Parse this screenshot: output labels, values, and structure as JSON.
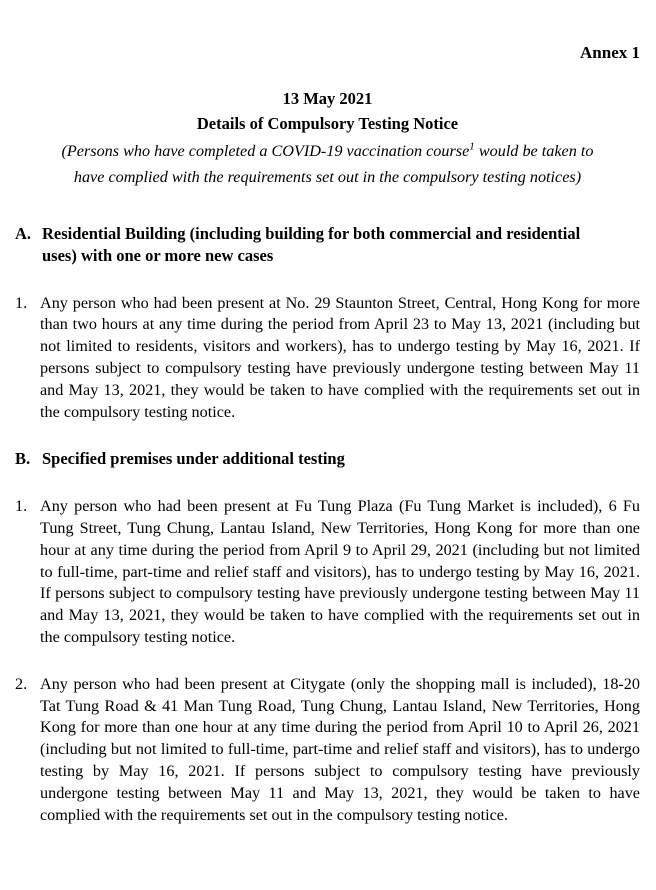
{
  "document": {
    "annex_label": "Annex 1",
    "date": "13 May 2021",
    "title": "Details of Compulsory Testing Notice",
    "subtitle": {
      "line1_before_sup": "(Persons who have completed a COVID-19 vaccination course",
      "footnote_ref": "1",
      "line1_after_sup": " would be taken to",
      "line2": "have complied with the requirements set out in the compulsory testing notices)"
    },
    "sections": [
      {
        "label": "A.",
        "heading": "Residential Building (including building for both commercial and residential uses) with one or more new cases",
        "items": [
          {
            "label": "1.",
            "text": "Any person who had been present at No. 29 Staunton Street, Central, Hong Kong for more than two hours at any time during the period from April 23 to May 13, 2021 (including but not limited to residents, visitors and workers), has to undergo testing by May 16, 2021. If persons subject to compulsory testing have previously undergone testing between May 11 and May 13, 2021, they would be taken to have complied with the requirements set out in the compulsory testing notice."
          }
        ]
      },
      {
        "label": "B.",
        "heading": "Specified premises under additional testing",
        "items": [
          {
            "label": "1.",
            "text": "Any person who had been present at Fu Tung Plaza (Fu Tung Market is included), 6 Fu Tung Street, Tung Chung, Lantau Island, New Territories, Hong Kong for more than one hour at any time during the period from April 9 to April 29, 2021 (including but not limited to full-time, part-time and relief staff and visitors), has to undergo testing by May 16, 2021. If persons subject to compulsory testing have previously undergone testing between May 11 and May 13, 2021, they would be taken to have complied with the requirements set out in the compulsory testing notice."
          },
          {
            "label": "2.",
            "text": "Any person who had been present at Citygate (only the shopping mall is included), 18-20 Tat Tung Road & 41 Man Tung Road, Tung Chung, Lantau Island, New Territories, Hong Kong for more than one hour at any time during the period from April 10 to April 26, 2021 (including but not limited to full-time, part-time and relief staff and visitors), has to undergo testing by May 16, 2021. If persons subject to compulsory testing have previously undergone testing between May 11 and May 13, 2021, they would be taken to have complied with the requirements set out in the compulsory testing notice."
          }
        ]
      }
    ]
  }
}
